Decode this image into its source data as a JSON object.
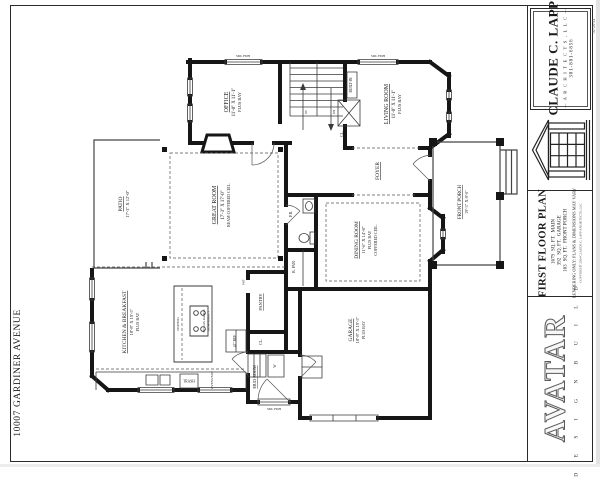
{
  "colors": {
    "ink": "#1a1a1a",
    "paper": "#ffffff"
  },
  "page": {
    "address": "10007 GARDINER AVENUE",
    "date": "02-26-24"
  },
  "title_block": {
    "firm": {
      "name": "CLAUDE C. LAPP",
      "subtitle": "— A R C H I T E C T S ,  L L C —",
      "phone": "301-881-6856"
    },
    "plan": {
      "title": "FIRST FLOOR PLAN",
      "areas": [
        {
          "value": "1679",
          "unit": "SQ. FT.",
          "label": "MAIN"
        },
        {
          "value": "392",
          "unit": "SQ. FT.",
          "label": "GARAGE"
        },
        {
          "value": "163",
          "unit": "SQ. FT.",
          "label": "FRONT PORCH"
        }
      ],
      "disclaimer": "RENDERING ONLY: PLANS & DIMENSIONS MAY VARY",
      "copyright": "COPYRIGHT 2024 CLAUDE C. LAPP ARCHITECTS, LLC"
    },
    "builder": {
      "name": "AVATAR",
      "tagline": "D E S I G N   B U I L D"
    }
  },
  "plan_labels": {
    "office": {
      "name": "OFFICE",
      "dims": "11'-0\" X 11'-1\"",
      "note": "PLUS BAY"
    },
    "living_room": {
      "name": "LIVING ROOM",
      "dims": "11'-0\" X 11'-1\"",
      "note": "PLUS BAY"
    },
    "great_room": {
      "name": "GREAT ROOM",
      "dims": "17'-3\" X 17'-0\"",
      "note": "BEAM COFFERED CEIL."
    },
    "patio": {
      "name": "PATIO",
      "dims": "17'-3\" X 12'-0\""
    },
    "foyer": {
      "name": "FOYER"
    },
    "dining_room": {
      "name": "DINING ROOM",
      "dims": "11'-6\" X 14'-8\"",
      "note": "PLUS BAY",
      "note2": "COFFERED CEIL."
    },
    "front_porch": {
      "name": "FRONT PORCH",
      "dims": "19'-3\" X 8'-0\""
    },
    "kitchen": {
      "name": "KITCHEN & BREAKFAST",
      "dims": "18'-8\" X 19'-5\"",
      "note": "PLUS BAY"
    },
    "garage": {
      "name": "GARAGE",
      "dims": "18'-8\" X 19'-5\"",
      "note": "PLUS BAY"
    },
    "pantry": "PANTRY",
    "mud_room": "MUD ROOM",
    "powder_room": "P.R.",
    "butlers_pantry": "B. PAN",
    "closet_stair": "CL.",
    "closet_mud": "CL.",
    "built_in": "BUILT-IN",
    "seating": "SEATING",
    "range": "36\" GAS RANGE",
    "range2": "DOWNDRAFT",
    "fridge": "42\" REF",
    "trash": "TRASH",
    "ovens": "OVENS/MW",
    "washer": "W",
    "pocket_door": "PKT",
    "window_tag": "SDL FDH",
    "up": "UP",
    "down": "DN"
  }
}
